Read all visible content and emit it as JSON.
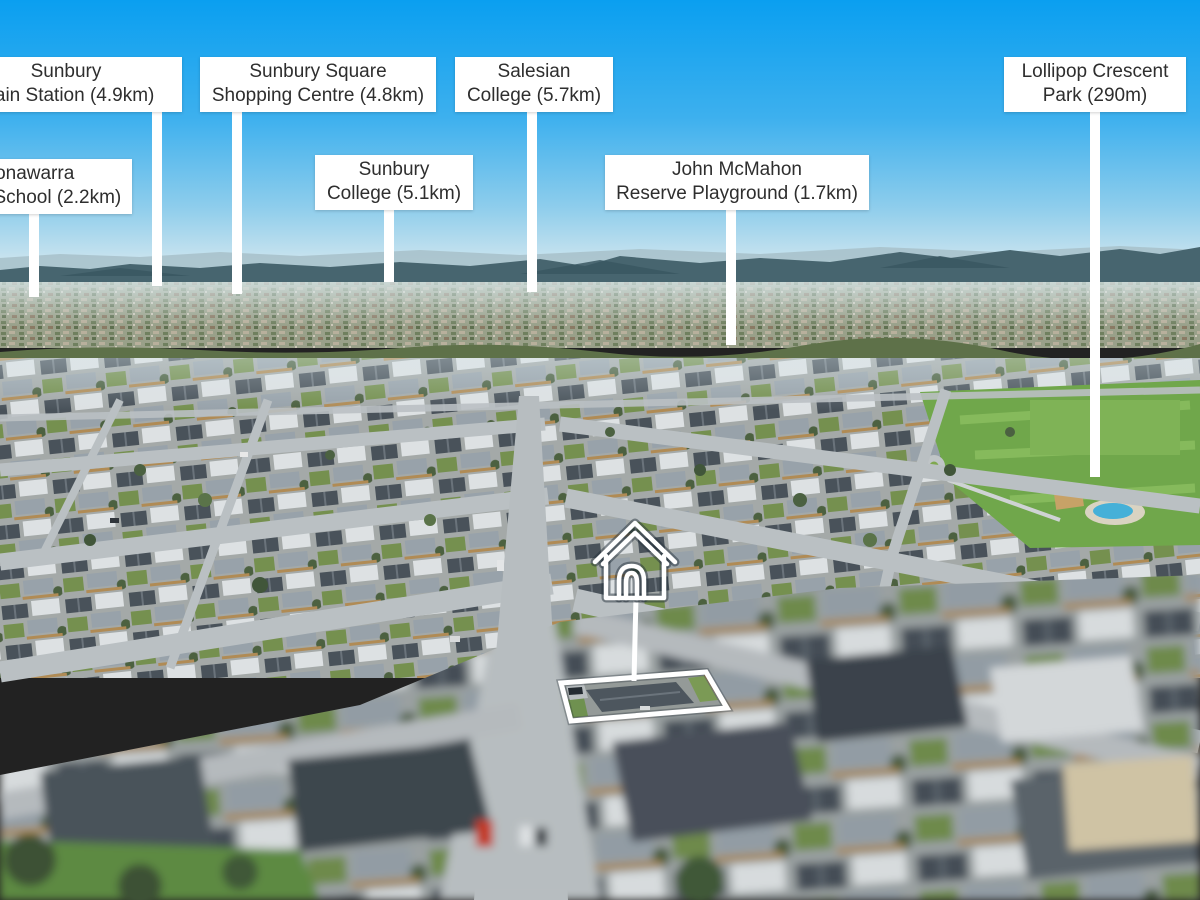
{
  "palette": {
    "sky_top": "#0a9ff0",
    "sky_horizon": "#d8ebf1",
    "label_background": "#ffffff",
    "label_text": "#2e2e2e",
    "leader_line": "#ffffff",
    "property_outline": "#ffffff",
    "park_green": "#70a74b",
    "roof_dark": "#49525a"
  },
  "callouts": [
    {
      "id": "sunbury-train-station",
      "line1": "Sunbury",
      "line2": "Train Station (4.9km)"
    },
    {
      "id": "goonawarra-primary-school",
      "line1": "Goonawarra",
      "line2": "Primary School (2.2km)"
    },
    {
      "id": "sunbury-square",
      "line1": "Sunbury Square",
      "line2": "Shopping Centre (4.8km)"
    },
    {
      "id": "sunbury-college",
      "line1": "Sunbury",
      "line2": "College (5.1km)"
    },
    {
      "id": "salesian-college",
      "line1": "Salesian",
      "line2": "College (5.7km)"
    },
    {
      "id": "john-mcmahon-reserve",
      "line1": "John McMahon",
      "line2": "Reserve Playground (1.7km)"
    },
    {
      "id": "lollipop-crescent-park",
      "line1": "Lollipop Crescent",
      "line2": "Park (290m)"
    }
  ],
  "marker": {
    "name": "subject-property",
    "icon": "house-outline"
  }
}
